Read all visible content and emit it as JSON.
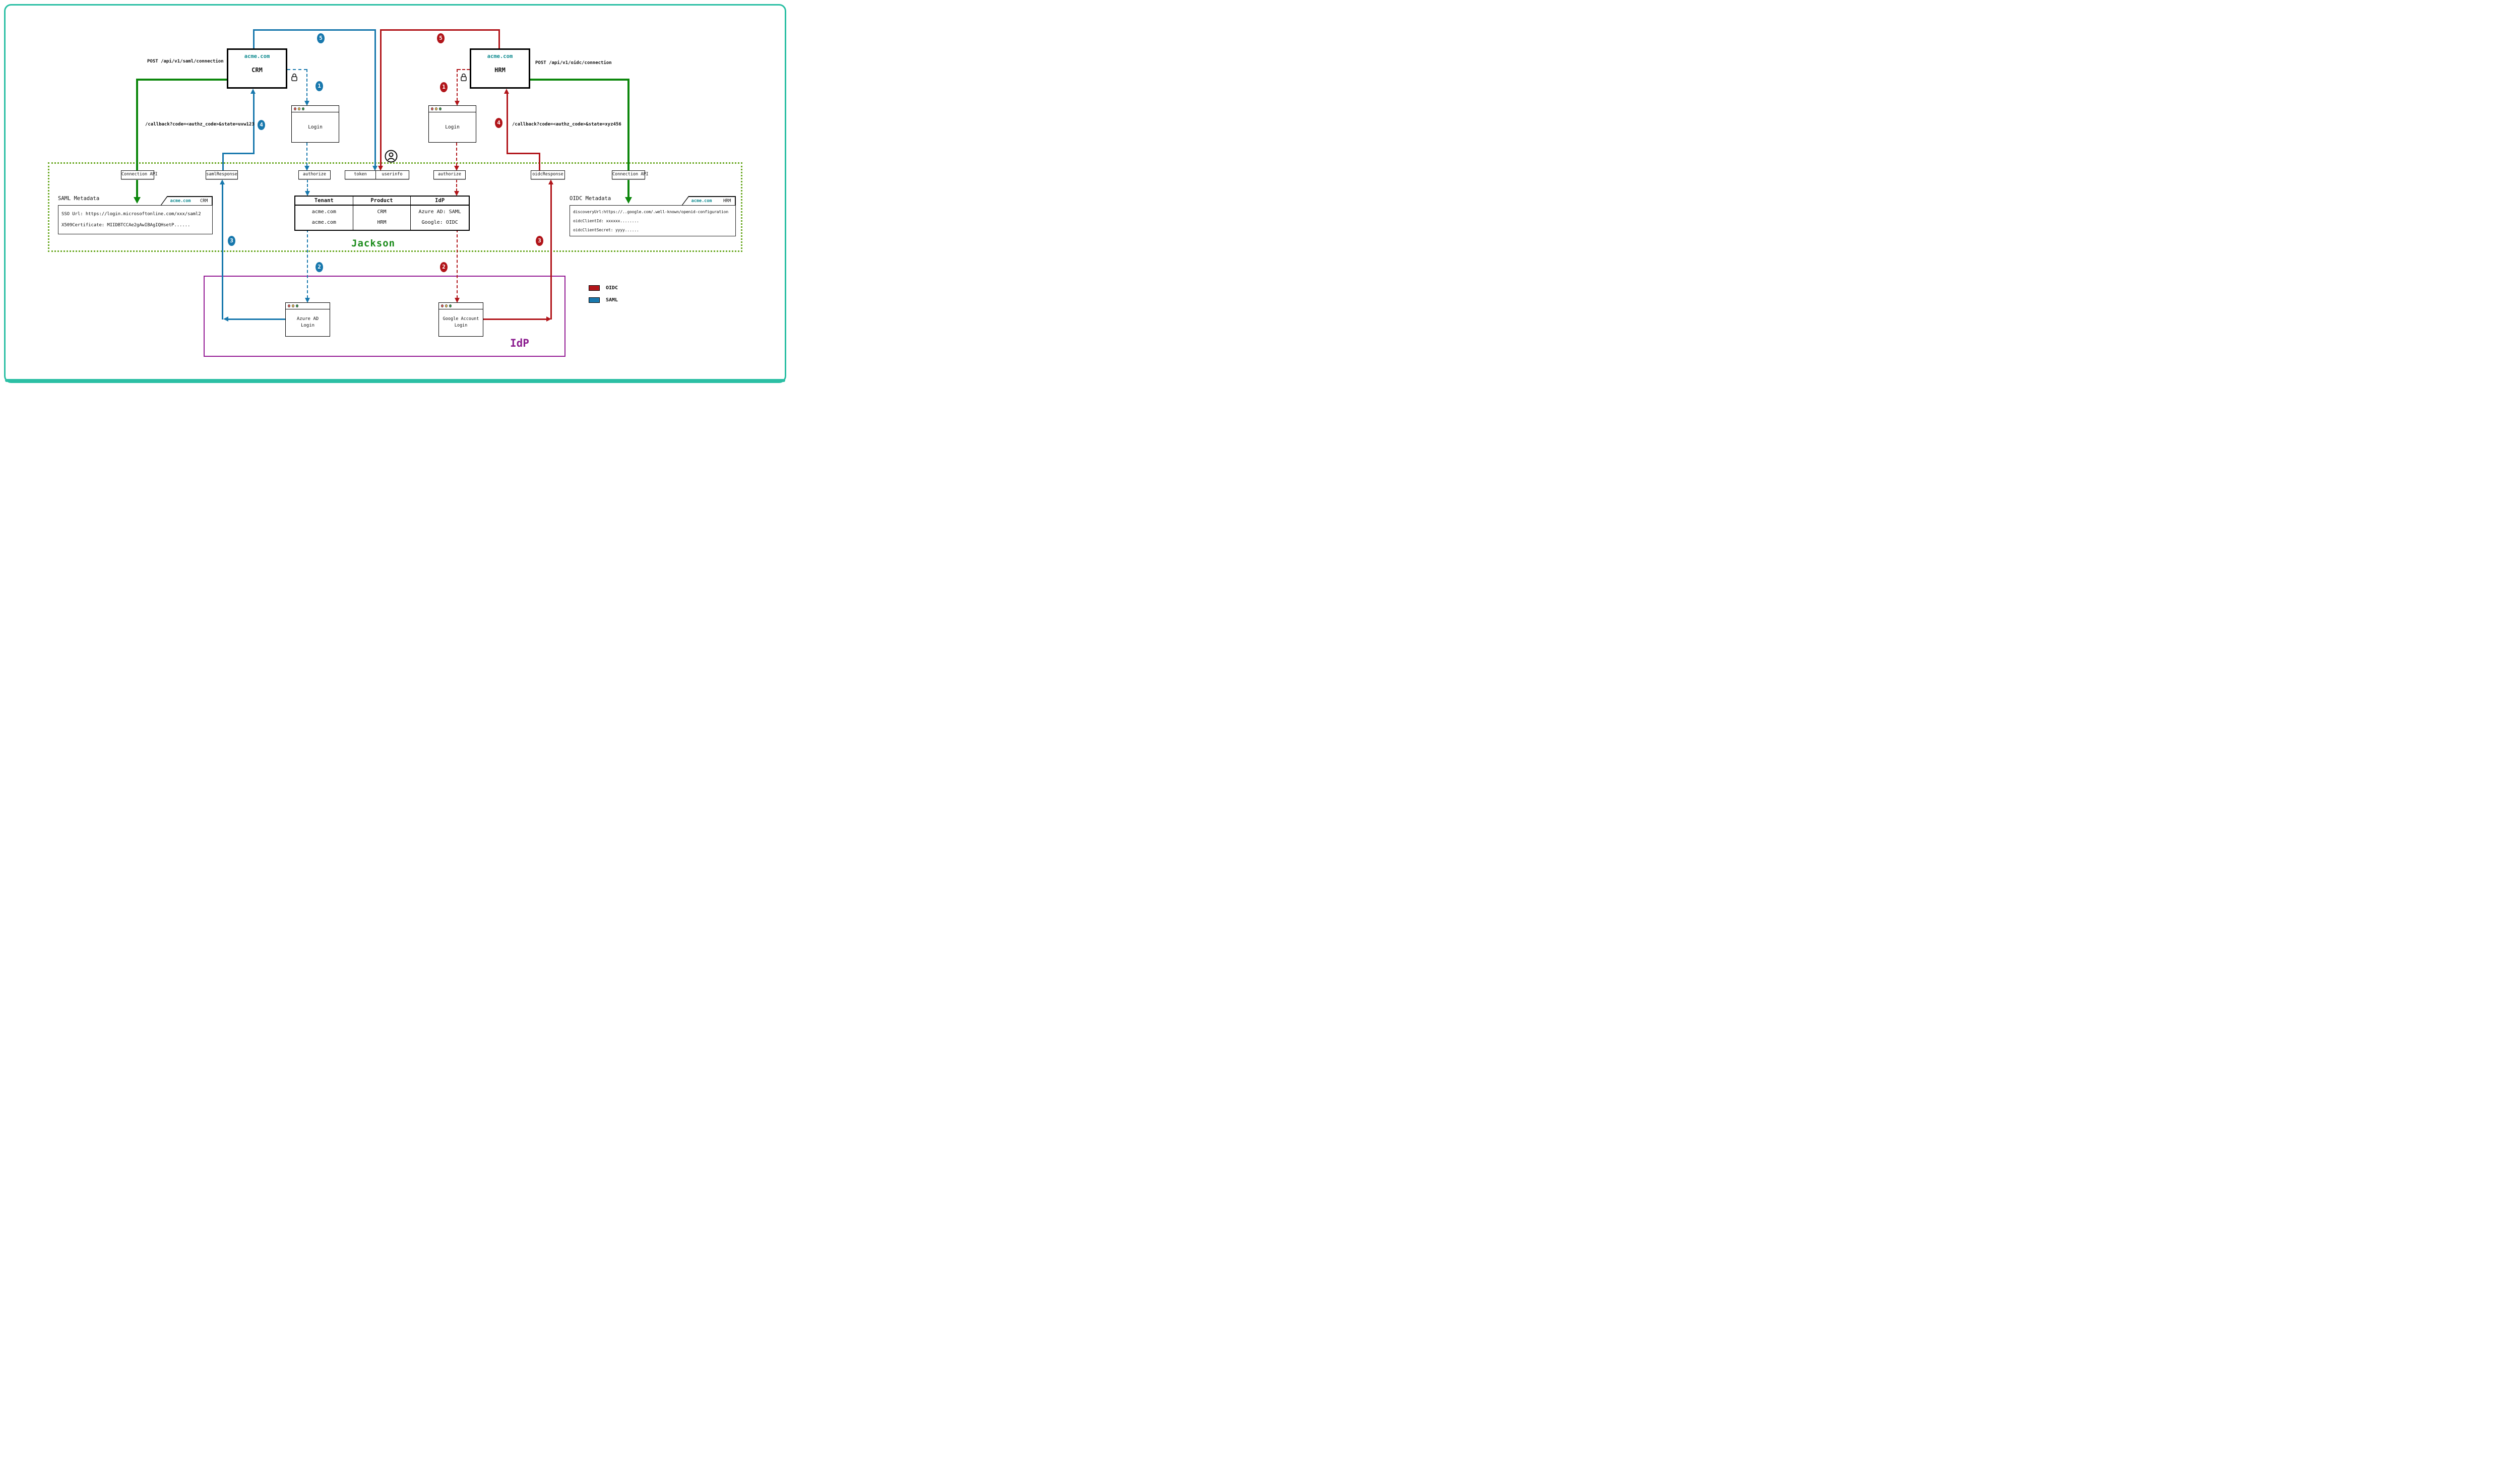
{
  "colors": {
    "saml_blue": "#1878ad",
    "oidc_red": "#b1151a",
    "api_green": "#0c870c",
    "jackson_green": "#188a18",
    "idp_purple": "#8b1c8f",
    "frame_teal": "#2bbfa4",
    "domain_teal": "#0e8a8f"
  },
  "crm": {
    "domain": "acme.com",
    "name": "CRM"
  },
  "hrm": {
    "domain": "acme.com",
    "name": "HRM"
  },
  "labels": {
    "post_saml": "POST /api/v1/saml/connection",
    "post_oidc": "POST /api/v1/oidc/connection",
    "callback_saml": "/callback?code=<authz_code>&state=uvw123",
    "callback_oidc": "/callback?code=<authz_code>&state=xyz456"
  },
  "steps": {
    "s1": "1",
    "s2": "2",
    "s3": "3",
    "s4": "4",
    "s5": "5"
  },
  "jackson": {
    "title": "Jackson",
    "endpoints": [
      "Connection API",
      "samlResponse",
      "authorize",
      "token",
      "userinfo",
      "authorize",
      "oidcResponse",
      "Connection API"
    ],
    "saml_metadata": {
      "title": "SAML Metadata",
      "tab_domain": "acme.com",
      "tab_product": "CRM",
      "lines": [
        "SSO Url: https://login.microsoftonline.com/xxx/saml2",
        "X509Certificate: MIIDBTCCAe2gAwIBAgIQHsetP......"
      ]
    },
    "oidc_metadata": {
      "title": "OIDC Metadata",
      "tab_domain": "acme.com",
      "tab_product": "HRM",
      "lines": [
        "discoveryUrl:https://..google.com/.well-known/openid-configuration",
        "oidcClientId: xxxxxx........",
        "oidcClientSecret: yyyy......"
      ]
    },
    "table": {
      "headers": [
        "Tenant",
        "Product",
        "IdP"
      ],
      "rows": [
        [
          "acme.com",
          "CRM",
          "Azure AD: SAML"
        ],
        [
          "acme.com",
          "HRM",
          "Google: OIDC"
        ]
      ]
    }
  },
  "idp": {
    "title": "IdP"
  },
  "windows": {
    "login_left": {
      "lines": [
        "Login"
      ]
    },
    "login_right": {
      "lines": [
        "Login"
      ]
    },
    "azure": {
      "lines": [
        "Azure AD",
        "Login"
      ]
    },
    "google": {
      "lines": [
        "Google Account",
        "Login"
      ]
    }
  },
  "legend": {
    "items": [
      {
        "label": "OIDC",
        "color": "#b1151a"
      },
      {
        "label": "SAML",
        "color": "#1878ad"
      }
    ]
  }
}
